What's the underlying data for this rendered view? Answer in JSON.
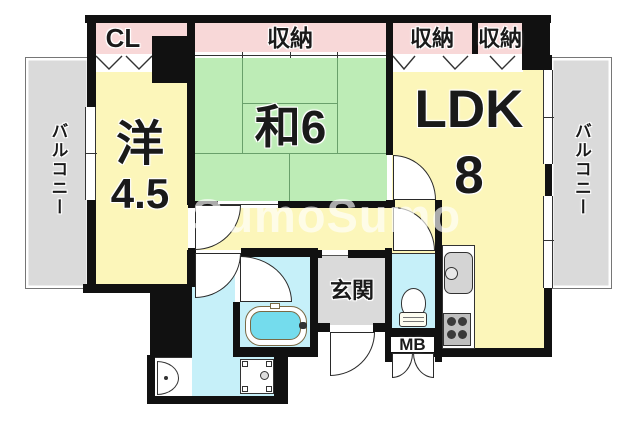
{
  "watermark": "SumoSumo",
  "labels": {
    "cl": "CL",
    "storage": "収納",
    "balcony": "バルコニー",
    "western_room": "洋",
    "western_room_size": "4.5",
    "japanese_room": "和6",
    "ldk": "LDK",
    "ldk_size": "8",
    "entrance": "玄関",
    "meter_box": "MB"
  },
  "rooms": [
    {
      "name": "western-room",
      "label": "洋 4.5"
    },
    {
      "name": "japanese-room",
      "label": "和6"
    },
    {
      "name": "living-dining-kitchen",
      "label": "LDK 8"
    },
    {
      "name": "entrance-hall",
      "label": "玄関"
    },
    {
      "name": "closet",
      "label": "CL"
    },
    {
      "name": "storage-japanese-room",
      "label": "収納"
    },
    {
      "name": "storage-ldk-1",
      "label": "収納"
    },
    {
      "name": "storage-ldk-2",
      "label": "収納"
    },
    {
      "name": "balcony-left",
      "label": "バルコニー"
    },
    {
      "name": "balcony-right",
      "label": "バルコニー"
    },
    {
      "name": "meter-box",
      "label": "MB"
    }
  ],
  "colors": {
    "wall": "#111111",
    "room": "#fcf6ba",
    "tatami": "#bdecb6",
    "closet": "#f8d8d8",
    "concrete": "#dadada",
    "wet": "#c6f0f9",
    "tub": "#74dced"
  }
}
